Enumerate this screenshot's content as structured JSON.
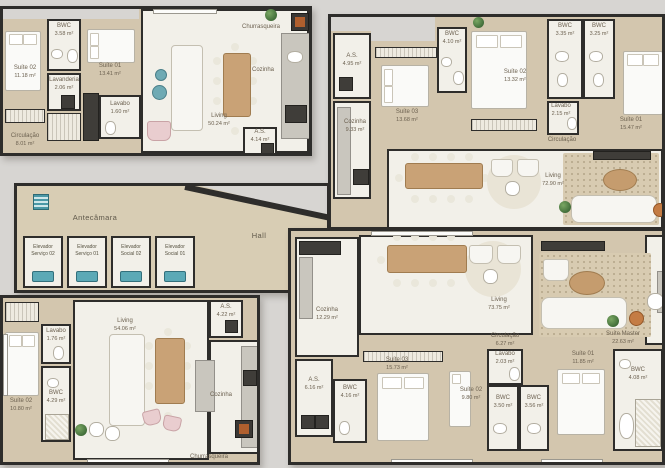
{
  "colors": {
    "wall": "#2e2d2b",
    "floor_tan": "#d3c6ae",
    "floor_white": "#f2f0e9",
    "outside": "#d7d5d2",
    "accent_teal": "#5ba9b6",
    "wood": "#c9a276"
  },
  "icons": {
    "stairs": "stairs-icon",
    "elevator_car": "elevator-car-icon",
    "plant": "plant-icon",
    "grill": "grill-icon"
  },
  "core": {
    "antechamber": "Antecâmara",
    "hall": "Hall",
    "elevators": [
      "Elevador Serviço 02",
      "Elevador Serviço 01",
      "Elevador Social 02",
      "Elevador Social 01"
    ]
  },
  "units": {
    "top_left": {
      "rooms": {
        "suite02": {
          "name": "Suíte 02",
          "area": "11.18 m²"
        },
        "bwc": {
          "name": "BWC",
          "area": "3.58 m²"
        },
        "laundry": {
          "name": "Lavanderia",
          "area": "2.06 m²"
        },
        "circulation": {
          "name": "Circulação",
          "area": "8.01 m²"
        },
        "suite01": {
          "name": "Suíte 01",
          "area": "13.41 m²"
        },
        "lavabo": {
          "name": "Lavabo",
          "area": "1.60 m²"
        },
        "living": {
          "name": "Living",
          "area": "50.24 m²"
        },
        "barbecue": {
          "name": "Churrasqueira"
        },
        "kitchen": {
          "name": "Cozinha"
        },
        "service": {
          "name": "A.S.",
          "area": "4.14 m²"
        }
      }
    },
    "top_right": {
      "rooms": {
        "service": {
          "name": "A.S.",
          "area": "4.95 m²"
        },
        "kitchen": {
          "name": "Cozinha",
          "area": "9.33 m²"
        },
        "suite03": {
          "name": "Suíte 03",
          "area": "13.68 m²"
        },
        "bwc1": {
          "name": "BWC",
          "area": "4.10 m²"
        },
        "suite02": {
          "name": "Suíte 02",
          "area": "13.32 m²"
        },
        "bwc2": {
          "name": "BWC",
          "area": "3.35 m²"
        },
        "bwc3": {
          "name": "BWC",
          "area": "3.25 m²"
        },
        "suite01": {
          "name": "Suíte 01",
          "area": "15.47 m²"
        },
        "lavabo": {
          "name": "Lavabo",
          "area": "2.15 m²"
        },
        "circulation": {
          "name": "Circulação"
        },
        "living": {
          "name": "Living",
          "area": "72.90 m²"
        }
      }
    },
    "bottom_left": {
      "rooms": {
        "suite02": {
          "name": "Suíte 02",
          "area": "10.80 m²"
        },
        "lavabo": {
          "name": "Lavabo",
          "area": "1.76 m²"
        },
        "bwc": {
          "name": "BWC",
          "area": "4.29 m²"
        },
        "living": {
          "name": "Living",
          "area": "54.06 m²"
        },
        "service": {
          "name": "A.S.",
          "area": "4.22 m²"
        },
        "kitchen": {
          "name": "Cozinha"
        },
        "barbecue": {
          "name": "Churrasqueira"
        }
      }
    },
    "bottom_right": {
      "rooms": {
        "kitchen": {
          "name": "Cozinha",
          "area": "12.29 m²"
        },
        "living": {
          "name": "Living",
          "area": "73.75 m²"
        },
        "service": {
          "name": "A.S.",
          "area": "6.16 m²"
        },
        "bwc1": {
          "name": "BWC",
          "area": "4.16 m²"
        },
        "suite03": {
          "name": "Suíte 03",
          "area": "15.73 m²"
        },
        "circulation": {
          "name": "Circulação",
          "area": "6.27 m²"
        },
        "master": {
          "name": "Suíte Master",
          "area": "22.63 m²"
        },
        "lavabo": {
          "name": "Lavabo",
          "area": "2.03 m²"
        },
        "suite02": {
          "name": "Suíte 02",
          "area": "9.80 m²"
        },
        "bwc2": {
          "name": "BWC",
          "area": "3.50 m²"
        },
        "bwc3": {
          "name": "BWC",
          "area": "3.56 m²"
        },
        "suite01": {
          "name": "Suíte 01",
          "area": "11.85 m²"
        },
        "bwc4": {
          "name": "BWC",
          "area": "4.08 m²"
        }
      }
    }
  }
}
